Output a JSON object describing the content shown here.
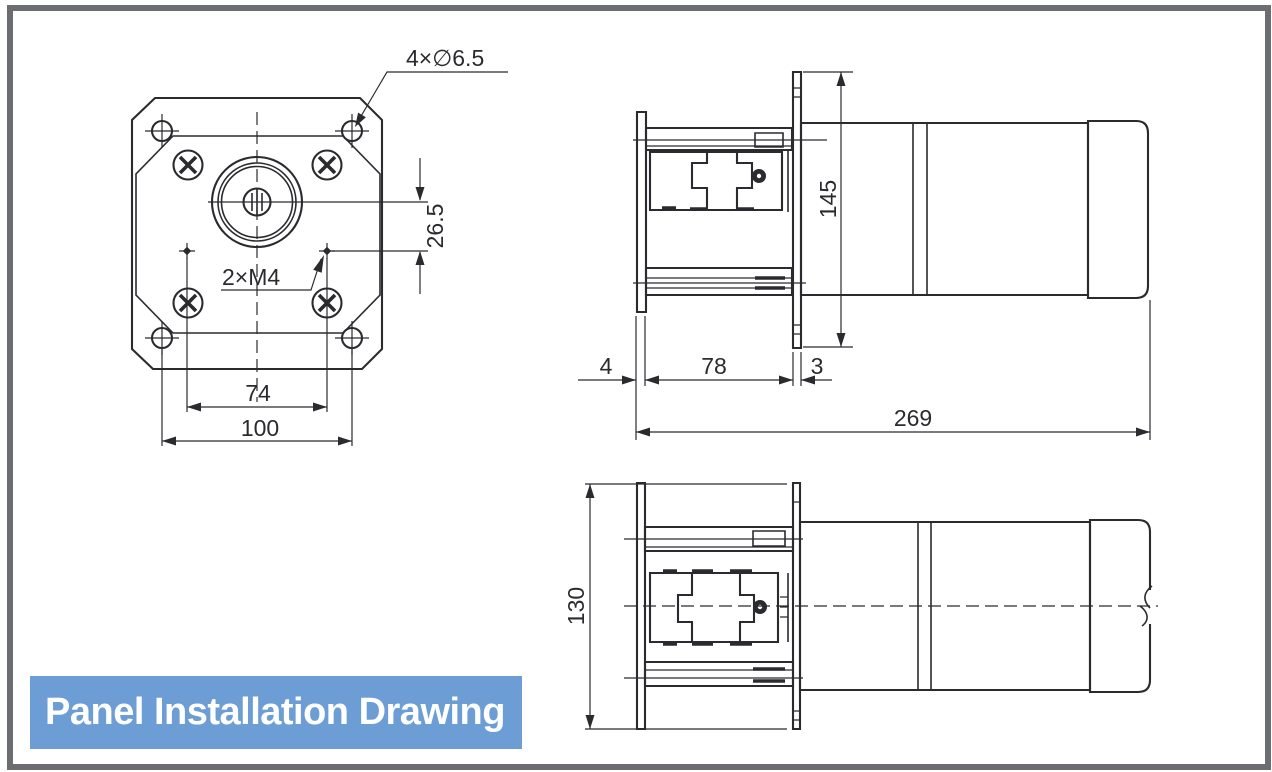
{
  "banner": {
    "label": "Panel Installation Drawing",
    "bg_color": "#6c9dd4",
    "text_color": "#ffffff"
  },
  "frame": {
    "color": "#6b6d71"
  },
  "drawing": {
    "line_color": "#2b2b2f"
  },
  "front_view": {
    "label_corner_holes": "4×∅6.5",
    "label_thread_holes": "2×M4",
    "dim_shaft_offset": "26.5",
    "dim_thread_spacing": "74",
    "dim_hole_spacing": "100"
  },
  "side_view": {
    "dim_flange_height": "145",
    "dim_front_plate": "4",
    "dim_behind_panel": "78",
    "dim_panel_thickness": "3",
    "dim_total_length": "269"
  },
  "top_view": {
    "dim_body_width": "130"
  }
}
